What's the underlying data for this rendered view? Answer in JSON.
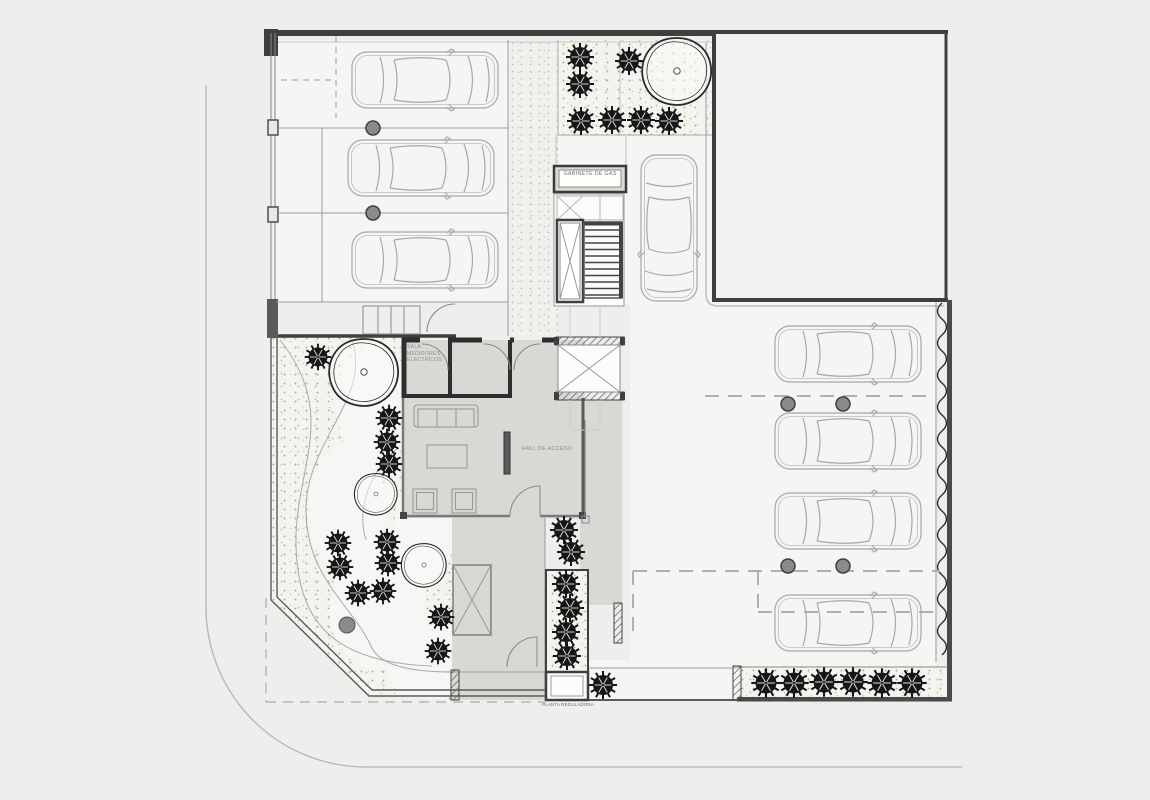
{
  "drawing": {
    "labels": {
      "gas_cabinet": "GABINETE DE GAS",
      "meter_room_lines": [
        "SALA",
        "MEDIDORES",
        "ELECTRICOS"
      ],
      "hall": "HALL DE ACCESO",
      "regulator": "PLANTA REGULADORA"
    },
    "counts": {
      "cars_parked_left": 3,
      "cars_parked_right": 4,
      "cars_in_driveway": 1,
      "shrubs_bottom_row": 6,
      "large_tree_canopies": 4
    },
    "colors": {
      "background": "#efeeec",
      "heavy_wall": "#3f3f3f",
      "interior_floor": "#d8d8d5",
      "thin_line": "#9a9a9a",
      "car_line": "#a8a8a8",
      "shrub": "#161616",
      "grass_dot": "#6faa5a"
    }
  }
}
